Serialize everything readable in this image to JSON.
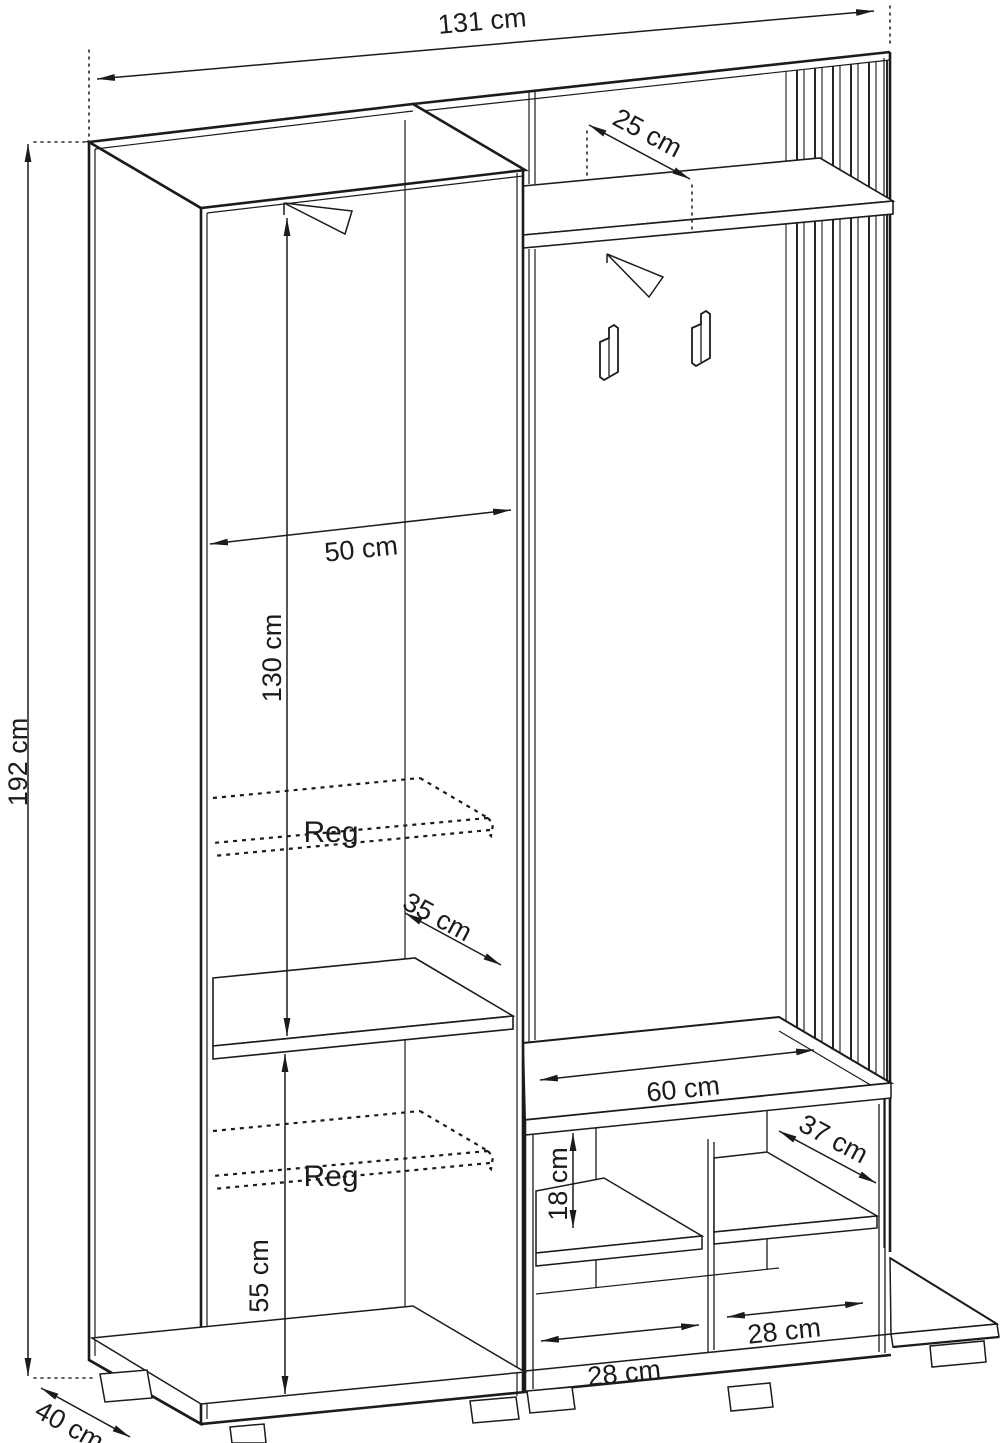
{
  "diagram": {
    "kind": "furniture dimension drawing",
    "units": "cm",
    "labels": {
      "total_width": "131 cm",
      "top_shelf_depth": "25 cm",
      "interior_width": "50 cm",
      "hanging_height": "130 cm",
      "adjustable_shelf_upper": "Reg",
      "middle_shelf_depth": "35 cm",
      "total_height": "192 cm",
      "adjustable_shelf_lower": "Reg",
      "lower_section_height": "55 cm",
      "total_depth": "40 cm",
      "bench_width": "60 cm",
      "bench_shelf_depth": "37 cm",
      "bench_shelf_spacing": "18 cm",
      "bench_left_compartment": "28 cm",
      "bench_right_compartment": "28 cm"
    },
    "colors": {
      "line": "#1b1b1b",
      "background": "#ffffff"
    }
  }
}
